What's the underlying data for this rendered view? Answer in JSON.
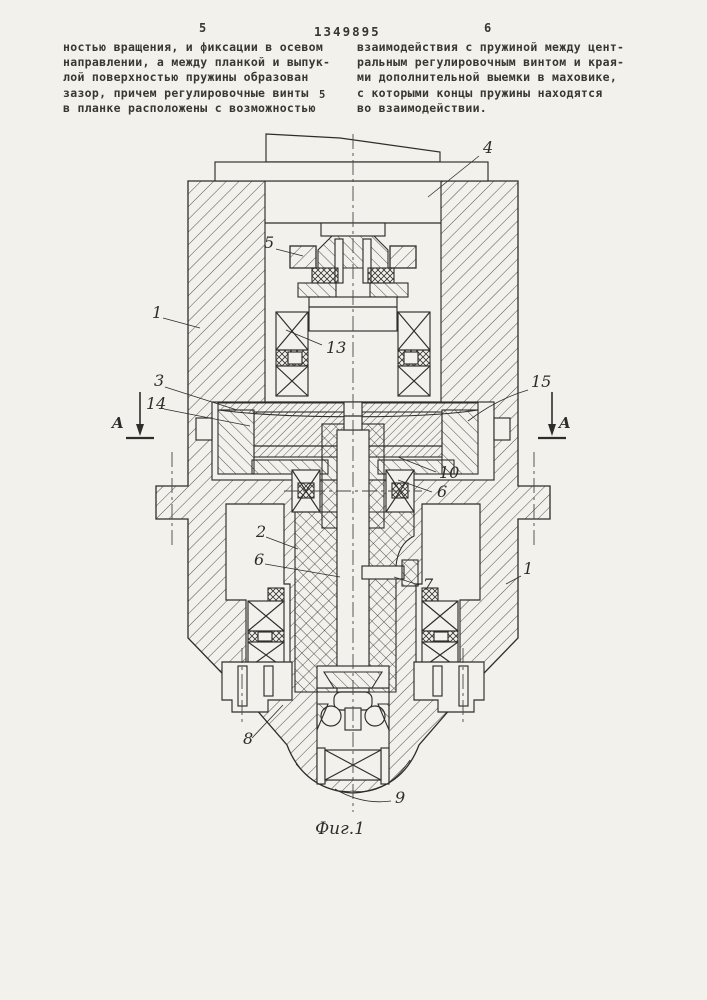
{
  "header": {
    "left_col_num": "5",
    "patent_number": "1349895",
    "right_col_num": "6",
    "margin_line_num": "5"
  },
  "text": {
    "left_column": "ностью вращения, и фиксации в осевом\nнаправлении, а между планкой и выпук-\nлой поверхностью пружины образован\nзазор, причем регулировочные винты\nв планке расположены с возможностью",
    "right_column": "взаимодействия с пружиной между цент-\nральным регулировочным винтом и края-\nми дополнительной выемки в маховике,\nс которыми концы пружины находятся\nво взаимодействии."
  },
  "figure": {
    "caption": "Фиг.1",
    "section_letter": "A",
    "labels": {
      "part1_upper": "1",
      "part1_lower": "1",
      "part2": "2",
      "part3": "3",
      "part4": "4",
      "part5": "5",
      "part6_right": "6",
      "part6_left": "6",
      "part7": "7",
      "part8": "8",
      "part9": "9",
      "part10": "10",
      "part13": "13",
      "part14": "14",
      "part15": "15"
    }
  },
  "colors": {
    "paper": "#f2f1ec",
    "ink": "#2f2d2a"
  }
}
